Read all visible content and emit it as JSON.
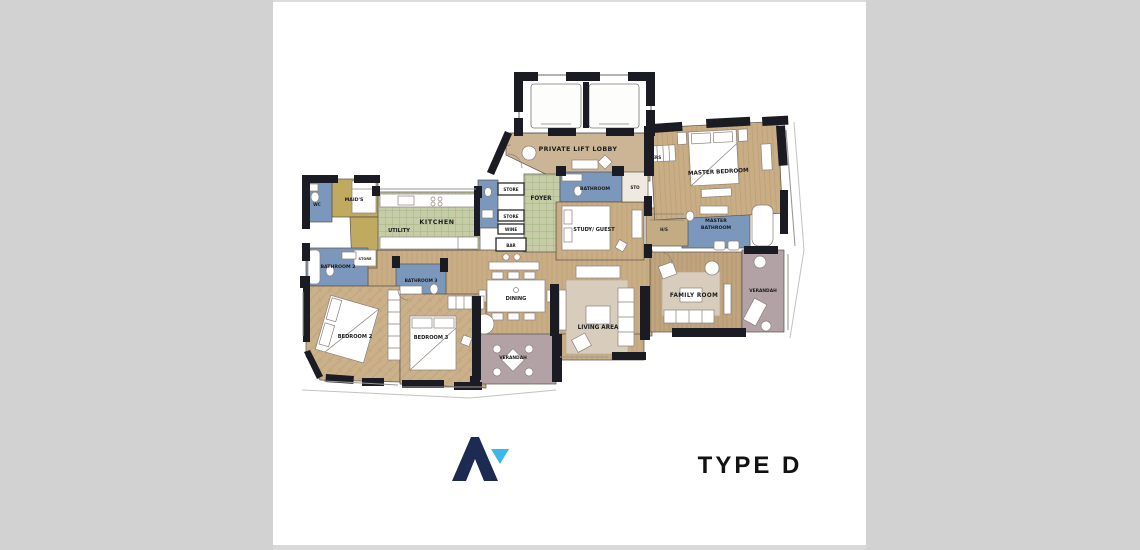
{
  "page": {
    "margin_color": "#d2d2d2",
    "canvas_color": "#ffffff",
    "type_label": "TYPE D"
  },
  "floorplan": {
    "rooms": {
      "private_lift_lobby": "PRIVATE LIFT LOBBY",
      "foyer": "FOYER",
      "kitchen": "KITCHEN",
      "maids": "MAID'S",
      "wc": "WC",
      "utility": "UTILITY",
      "store_left": "STORE",
      "store_1": "STORE",
      "store_2": "STORE",
      "wine": "WINE",
      "bar": "BAR",
      "bathroom_1": "BATHROOM",
      "sto": "STO",
      "study_guest": "STUDY/ GUEST",
      "hs": "H/S",
      "hers": "HERS",
      "master_bedroom": "MASTER BEDROOM",
      "master_bathroom": {
        "line1": "MASTER",
        "line2": "BATHROOM"
      },
      "family_room": "FAMILY ROOM",
      "verandah_right": "VERANDAH",
      "living_area": "LIVING AREA",
      "dining": "DINING",
      "verandah_bottom": "VERANDAH",
      "bathroom_2": "BATHROOM 2",
      "bathroom_3": "BATHROOM 3",
      "bedroom_2": "BEDROOM 2",
      "bedroom_3": "BEDROOM 3"
    },
    "colors": {
      "wall": "#1b1b24",
      "bathroom_blue": "#7b97bb",
      "service_olive": "#c0aa60",
      "kitchen_green": "#c6cda6",
      "floor_tan": "#c8ad85",
      "lobby_tan": "#ccb594",
      "verandah_mauve": "#b2a2a5",
      "furniture_white": "#ffffff"
    },
    "logo": {
      "navy": "#1d2a52",
      "light_blue": "#3db6e9"
    }
  }
}
